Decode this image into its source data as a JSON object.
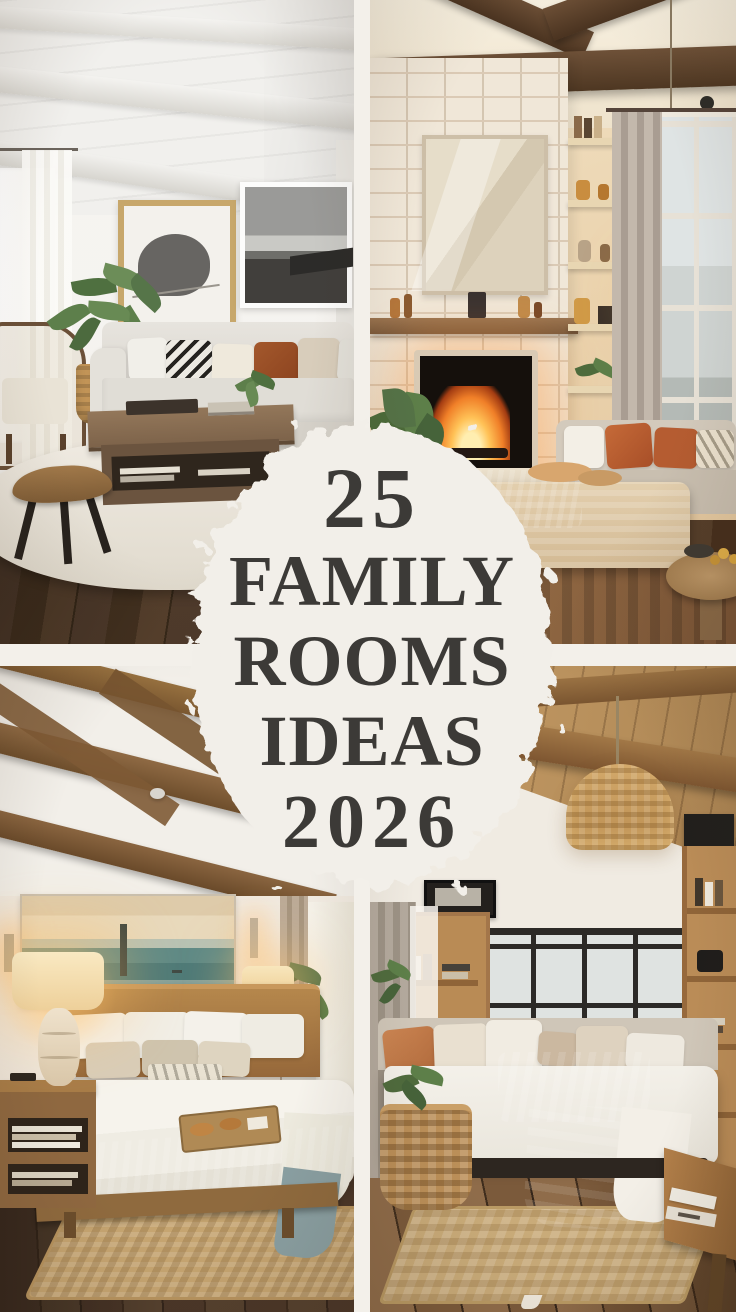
{
  "badge": {
    "lines": [
      "25",
      "FAMILY",
      "ROOMS",
      "IDEAS",
      "2026"
    ],
    "paper_color": "#f2efe9",
    "text_color": "#3c3a37"
  },
  "collage": {
    "divider_color": "#f3f0ea",
    "photos": [
      {
        "position": "top-left",
        "name": "bright-living-room"
      },
      {
        "position": "top-right",
        "name": "fireplace-family-room"
      },
      {
        "position": "bottom-left",
        "name": "warm-wood-bedroom"
      },
      {
        "position": "bottom-right",
        "name": "daybed-library-room"
      }
    ],
    "accent_colors": {
      "rust_pillow": "#a3582c",
      "fire_glow": "#f07f28",
      "wood_beam": "#5d4531",
      "sage_throw": "#8da2a6",
      "jute_rug": "#c6a571"
    }
  }
}
